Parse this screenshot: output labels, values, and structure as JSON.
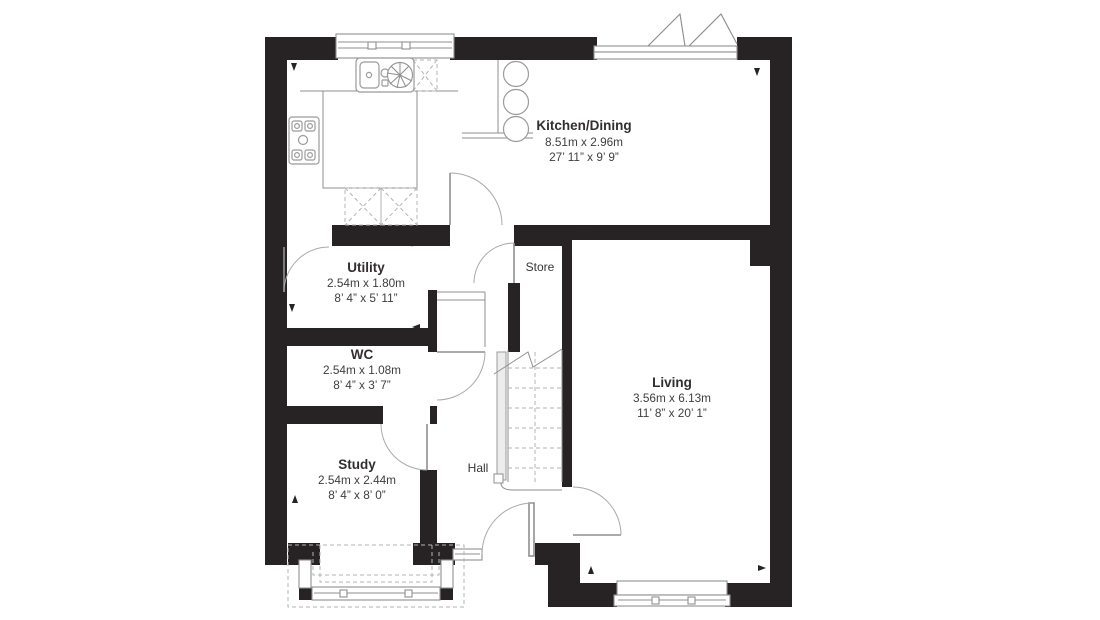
{
  "plan": {
    "title": "Ground floor plan",
    "colors": {
      "wall": "#272324",
      "line": "#8f8f8f",
      "dashed": "#b3b3b3",
      "text": "#383435",
      "background": "#ffffff"
    },
    "rooms": [
      {
        "name": "Kitchen/Dining",
        "metric": "8.51m x 2.96m",
        "imperial": "27’ 11” x 9’ 9”"
      },
      {
        "name": "Utility",
        "metric": "2.54m x 1.80m",
        "imperial": "8’ 4” x 5’ 11”"
      },
      {
        "name": "WC",
        "metric": "2.54m x 1.08m",
        "imperial": "8’ 4” x 3’ 7”"
      },
      {
        "name": "Study",
        "metric": "2.54m x 2.44m",
        "imperial": "8’ 4” x 8’ 0”"
      },
      {
        "name": "Living",
        "metric": "3.56m x 6.13m",
        "imperial": "11’ 8” x 20’ 1”"
      },
      {
        "name": "Store"
      },
      {
        "name": "Hall"
      }
    ]
  }
}
